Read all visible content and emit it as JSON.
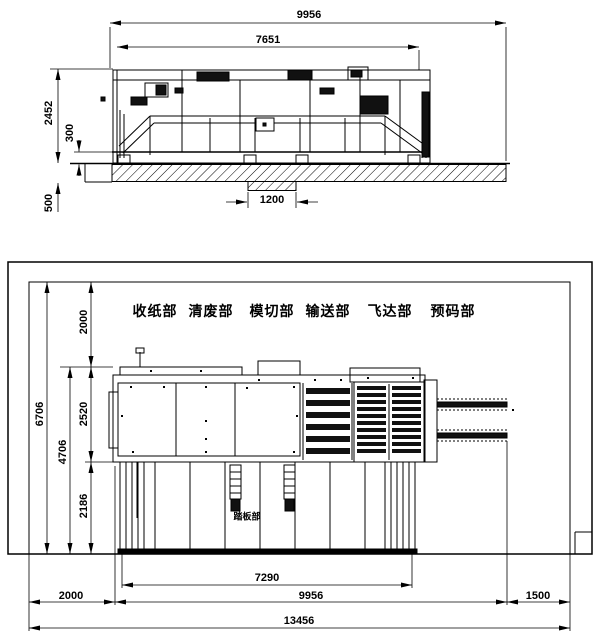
{
  "elevation": {
    "dim_total_length": "9956",
    "dim_body_length": "7651",
    "dim_height": "2452",
    "dim_base_height": "300",
    "dim_foundation_depth": "500",
    "dim_pit_width": "1200"
  },
  "plan": {
    "sections": [
      "收纸部",
      "清废部",
      "模切部",
      "输送部",
      "飞达部",
      "预码部"
    ],
    "platform_label": "踏板部",
    "dim_top_clearance": "2000",
    "dim_room_depth": "6706",
    "dim_machine_depth": "2520",
    "dim_work_area_depth": "4706",
    "dim_platform_depth": "2186",
    "dim_platform_length": "7290",
    "dim_left_clearance": "2000",
    "dim_machine_length": "9956",
    "dim_right_clearance": "1500",
    "dim_total_length": "13456"
  }
}
